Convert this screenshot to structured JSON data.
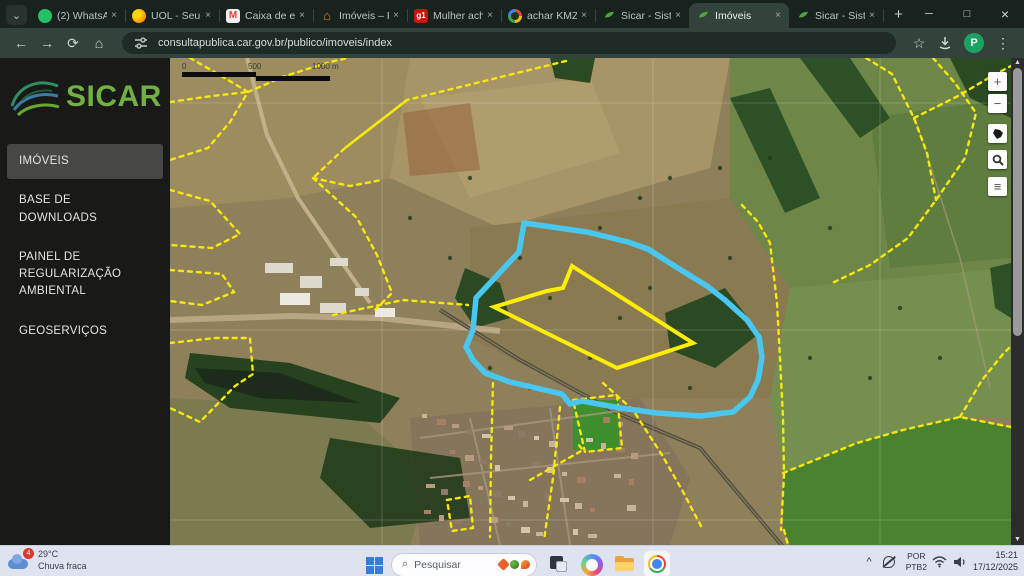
{
  "browser": {
    "tab_search_glyph": "⌄",
    "tabs": [
      {
        "label": "(2) WhatsApp",
        "icon": "whatsapp-icon"
      },
      {
        "label": "UOL - Seu un",
        "icon": "uol-icon"
      },
      {
        "label": "Caixa de entr",
        "icon": "gmail-icon",
        "glyph": "M"
      },
      {
        "label": "Imóveis – PA",
        "icon": "house-icon",
        "glyph": "⌂"
      },
      {
        "label": "Mulher acha",
        "icon": "g1-icon",
        "glyph": "g1"
      },
      {
        "label": "achar KMZ c",
        "icon": "google-icon"
      },
      {
        "label": "Sicar - Sistem",
        "icon": "sicar-leaf-icon"
      },
      {
        "label": "Imóveis",
        "icon": "sicar-leaf-icon",
        "active": true
      },
      {
        "label": "Sicar - Sistem",
        "icon": "sicar-leaf-icon"
      }
    ],
    "close_glyph": "×",
    "new_tab_glyph": "+",
    "window_controls": {
      "minimize": "─",
      "maximize": "□",
      "close": "×"
    },
    "nav": {
      "back": "←",
      "forward": "→",
      "reload": "⟳",
      "home": "⌂",
      "bookmark": "☆",
      "menu": "⋮"
    },
    "url": "consultapublica.car.gov.br/publico/imoveis/index",
    "profile_initial": "P"
  },
  "sidebar": {
    "logo_text": "SICAR",
    "items": [
      {
        "label": "IMÓVEIS"
      },
      {
        "label": "BASE DE DOWNLOADS"
      },
      {
        "label": "PAINEL DE REGULARIZAÇÃO AMBIENTAL"
      },
      {
        "label": "GEOSERVIÇOS"
      }
    ]
  },
  "map": {
    "scale": {
      "start": "0",
      "mid": "500",
      "end": "1000 m"
    },
    "controls": {
      "zoom_in": "+",
      "zoom_out": "−",
      "layers": "≡"
    },
    "colors": {
      "parcel_boundary_yellow": "#f6e70e",
      "selected_parcel_yellow": "#ffee00",
      "drawn_area_cyan": "#4ac7f0"
    }
  },
  "taskbar": {
    "weather": {
      "badge": "4",
      "temperature": "29°C",
      "condition": "Chuva fraca"
    },
    "search_placeholder": "Pesquisar",
    "tray": {
      "chevron": "^",
      "language_top": "POR",
      "language_bottom": "PTB2",
      "time": "15:21",
      "date": "17/12/2025"
    }
  }
}
